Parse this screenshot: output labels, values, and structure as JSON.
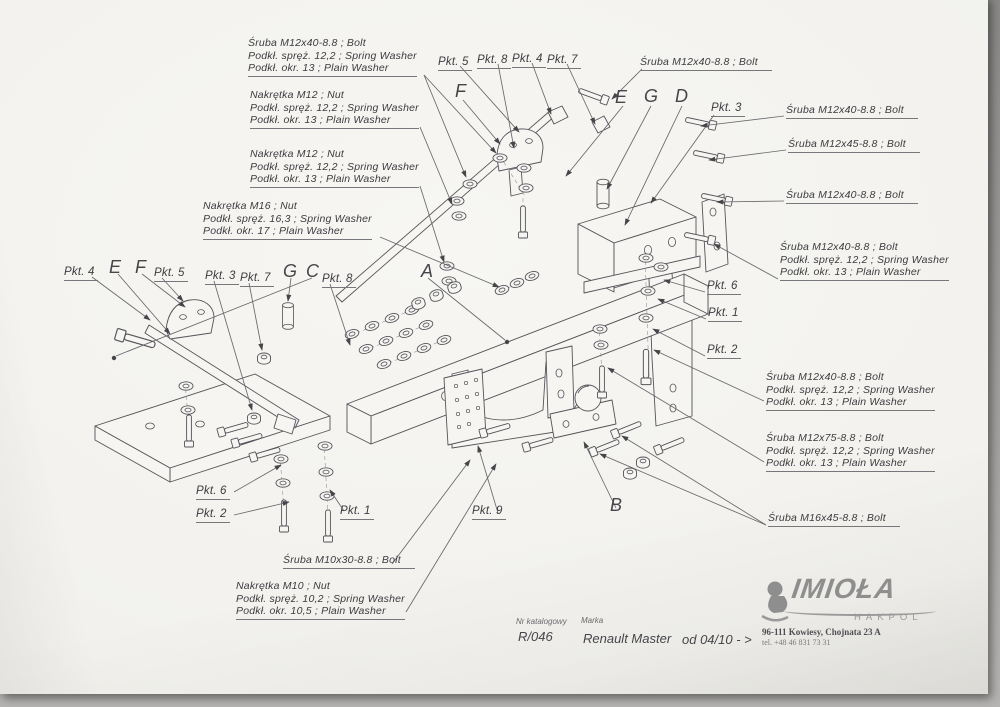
{
  "sheet": {
    "callouts": [
      {
        "name": "callout-bolt-m12x40-washers-top-left",
        "kind": "parts",
        "x": 248,
        "y": 41,
        "lines": [
          "Śruba M12x40-8.8 ;  Bolt",
          "Podkł. spręż. 12,2 ; Spring Washer",
          "Podkł. okr. 13 ; Plain Washer"
        ]
      },
      {
        "name": "callout-nut-m12-washers-1",
        "kind": "parts",
        "x": 250,
        "y": 93,
        "lines": [
          "Nakrętka  M12 ; Nut",
          "Podkł. spręż. 12,2 ; Spring Washer",
          "Podkł. okr. 13 ; Plain Washer"
        ]
      },
      {
        "name": "callout-nut-m12-washers-2",
        "kind": "parts",
        "x": 250,
        "y": 152,
        "lines": [
          "Nakrętka  M12 ; Nut",
          "Podkł. spręż. 12,2 ; Spring Washer",
          "Podkł. okr. 13 ; Plain Washer"
        ]
      },
      {
        "name": "callout-nut-m16-washers",
        "kind": "parts",
        "x": 203,
        "y": 204,
        "lines": [
          "Nakrętka  M16 ; Nut",
          "Podkł. spręż. 16,3 ; Spring Washer",
          "Podkł. okr. 17 ; Plain Washer"
        ]
      },
      {
        "name": "pkt-5-top",
        "kind": "pkt",
        "x": 438,
        "y": 60,
        "lines": [
          "Pkt. 5"
        ]
      },
      {
        "name": "pkt-8-top",
        "kind": "pkt",
        "x": 477,
        "y": 58,
        "lines": [
          "Pkt. 8"
        ]
      },
      {
        "name": "pkt-4-top",
        "kind": "pkt",
        "x": 512,
        "y": 57,
        "lines": [
          "Pkt. 4"
        ]
      },
      {
        "name": "pkt-7-top",
        "kind": "pkt",
        "x": 547,
        "y": 58,
        "lines": [
          "Pkt. 7"
        ]
      },
      {
        "name": "marker-f-top",
        "kind": "letter",
        "x": 455,
        "y": 86,
        "lines": [
          "F"
        ]
      },
      {
        "name": "callout-bolt-m12x40-top-right",
        "kind": "parts1",
        "x": 640,
        "y": 60,
        "lines": [
          "Śruba M12x40-8.8 ;  Bolt"
        ]
      },
      {
        "name": "marker-e-top",
        "kind": "letter",
        "x": 615,
        "y": 92,
        "lines": [
          "E"
        ]
      },
      {
        "name": "marker-g-top",
        "kind": "letter",
        "x": 644,
        "y": 91,
        "lines": [
          "G"
        ]
      },
      {
        "name": "marker-d-top",
        "kind": "letter",
        "x": 675,
        "y": 91,
        "lines": [
          "D"
        ]
      },
      {
        "name": "pkt-3-right",
        "kind": "pkt",
        "x": 711,
        "y": 106,
        "lines": [
          "Pkt. 3"
        ]
      },
      {
        "name": "callout-bolt-m12x40-right-1",
        "kind": "parts1",
        "x": 786,
        "y": 108,
        "lines": [
          "Śruba M12x40-8.8 ;  Bolt"
        ]
      },
      {
        "name": "callout-bolt-m12x45-right",
        "kind": "parts1",
        "x": 788,
        "y": 142,
        "lines": [
          "Śruba M12x45-8.8 ;  Bolt"
        ]
      },
      {
        "name": "callout-bolt-m12x40-right-2",
        "kind": "parts1",
        "x": 786,
        "y": 193,
        "lines": [
          "Śruba M12x40-8.8 ;  Bolt"
        ]
      },
      {
        "name": "callout-bolt-m12x40-washers-right",
        "kind": "parts",
        "x": 780,
        "y": 245,
        "lines": [
          "Śruba M12x40-8.8 ;  Bolt",
          "Podkł. spręż. 12,2 ; Spring Washer",
          "Podkł. okr. 13 ; Plain Washer"
        ]
      },
      {
        "name": "pkt-6-right",
        "kind": "pkt",
        "x": 707,
        "y": 284,
        "lines": [
          "Pkt. 6"
        ]
      },
      {
        "name": "pkt-1-right",
        "kind": "pkt",
        "x": 708,
        "y": 311,
        "lines": [
          "Pkt. 1"
        ]
      },
      {
        "name": "pkt-2-right",
        "kind": "pkt",
        "x": 707,
        "y": 348,
        "lines": [
          "Pkt. 2"
        ]
      },
      {
        "name": "callout-bolt-m12x40-washers-bottom-right",
        "kind": "parts",
        "x": 766,
        "y": 375,
        "lines": [
          "Śruba M12x40-8.8 ;  Bolt",
          "Podkł. spręż. 12,2 ; Spring Washer",
          "Podkł. okr. 13 ; Plain Washer"
        ]
      },
      {
        "name": "callout-bolt-m12x75-washers",
        "kind": "parts",
        "x": 766,
        "y": 436,
        "lines": [
          "Śruba M12x75-8.8 ;  Bolt",
          "Podkł. spręż. 12,2 ; Spring Washer",
          "Podkł. okr. 13 ; Plain Washer"
        ]
      },
      {
        "name": "callout-bolt-m16x45",
        "kind": "parts1",
        "x": 768,
        "y": 516,
        "lines": [
          "Śruba M16x45-8.8 ;  Bolt"
        ]
      },
      {
        "name": "pkt-4-left",
        "kind": "pkt",
        "x": 64,
        "y": 270,
        "lines": [
          "Pkt. 4"
        ]
      },
      {
        "name": "marker-e-left",
        "kind": "letter",
        "x": 109,
        "y": 262,
        "lines": [
          "E"
        ]
      },
      {
        "name": "marker-f-left",
        "kind": "letter",
        "x": 135,
        "y": 262,
        "lines": [
          "F"
        ]
      },
      {
        "name": "pkt-5-left",
        "kind": "pkt",
        "x": 154,
        "y": 271,
        "lines": [
          "Pkt. 5"
        ]
      },
      {
        "name": "pkt-3-left",
        "kind": "pkt",
        "x": 205,
        "y": 274,
        "lines": [
          "Pkt. 3"
        ]
      },
      {
        "name": "pkt-7-left",
        "kind": "pkt",
        "x": 240,
        "y": 276,
        "lines": [
          "Pkt. 7"
        ]
      },
      {
        "name": "marker-g-left",
        "kind": "letter",
        "x": 283,
        "y": 266,
        "lines": [
          "G"
        ]
      },
      {
        "name": "marker-c-left",
        "kind": "letter",
        "x": 306,
        "y": 266,
        "lines": [
          "C"
        ]
      },
      {
        "name": "pkt-8-left",
        "kind": "pkt",
        "x": 322,
        "y": 277,
        "lines": [
          "Pkt. 8"
        ]
      },
      {
        "name": "marker-a",
        "kind": "letter",
        "x": 421,
        "y": 266,
        "lines": [
          "A"
        ]
      },
      {
        "name": "pkt-6-bottom",
        "kind": "pkt",
        "x": 196,
        "y": 489,
        "lines": [
          "Pkt. 6"
        ]
      },
      {
        "name": "pkt-2-bottom",
        "kind": "pkt",
        "x": 196,
        "y": 512,
        "lines": [
          "Pkt. 2"
        ]
      },
      {
        "name": "pkt-1-bottom",
        "kind": "pkt",
        "x": 340,
        "y": 509,
        "lines": [
          "Pkt. 1"
        ]
      },
      {
        "name": "callout-bolt-m10x30",
        "kind": "parts1",
        "x": 283,
        "y": 558,
        "lines": [
          "Śruba M10x30-8.8 ;  Bolt"
        ]
      },
      {
        "name": "callout-nut-m10-washers",
        "kind": "parts",
        "x": 236,
        "y": 584,
        "lines": [
          "Nakrętka  M10 ; Nut",
          "Podkł. spręż. 10,2 ; Spring Washer",
          "Podkł. okr. 10,5 ; Plain Washer"
        ]
      },
      {
        "name": "pkt-9",
        "kind": "pkt",
        "x": 472,
        "y": 509,
        "lines": [
          "Pkt. 9"
        ]
      },
      {
        "name": "marker-b",
        "kind": "letter",
        "x": 610,
        "y": 500,
        "lines": [
          "B"
        ]
      }
    ],
    "title_block": {
      "catalog_label": "Nr katalogowy",
      "catalog_value": "R/046",
      "brand_label": "Marka",
      "brand_value": "Renault Master",
      "applicability": "od 04/10 - >"
    },
    "manufacturer": {
      "logo_text": "IMIOŁA",
      "logo_subtext": "HAKPOL",
      "address": "96-111 Kowiesy, Chojnata 23 A",
      "phone": "tel.  +48 46 831 73 31"
    }
  }
}
